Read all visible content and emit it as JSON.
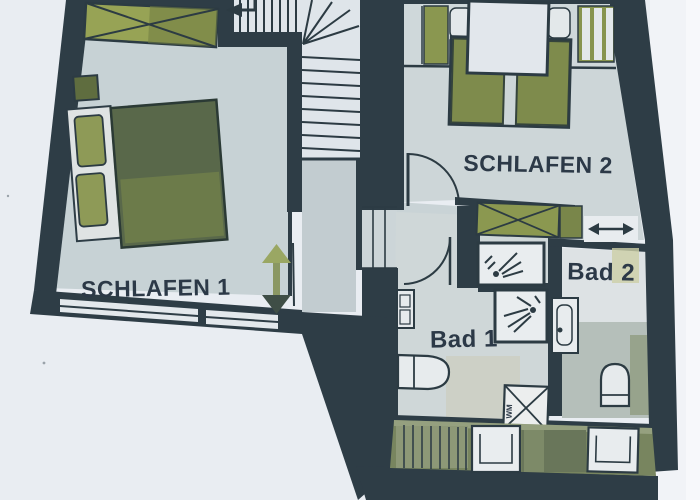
{
  "plan": {
    "title": "Obergeschoss Grundriss",
    "rooms": [
      {
        "id": "schlafen-1",
        "label": "SCHLAFEN 1",
        "type": "bedroom"
      },
      {
        "id": "schlafen-2",
        "label": "SCHLAFEN 2",
        "type": "bedroom"
      },
      {
        "id": "bad-1",
        "label": "Bad 1",
        "type": "bathroom"
      },
      {
        "id": "bad-2",
        "label": "Bad 2",
        "type": "bathroom"
      }
    ],
    "appliances": {
      "washing_machine": "WM"
    },
    "symbols": [
      "stair-direction-arrow",
      "height-clearance-arrow",
      "window-opening-arrow",
      "wardrobe-cross",
      "shower-spray",
      "wc",
      "sink",
      "bed",
      "roof-window"
    ],
    "colors": {
      "paper": "#e9edf2",
      "wall": "#2e3d46",
      "floor": "#c9d4d7",
      "bath_floor": "#d8dde0",
      "furniture_green": "#8b9850",
      "bed_green": "#5d6b4b",
      "label_text": "#2c3947",
      "arrow_olive": "#96a35f"
    }
  }
}
